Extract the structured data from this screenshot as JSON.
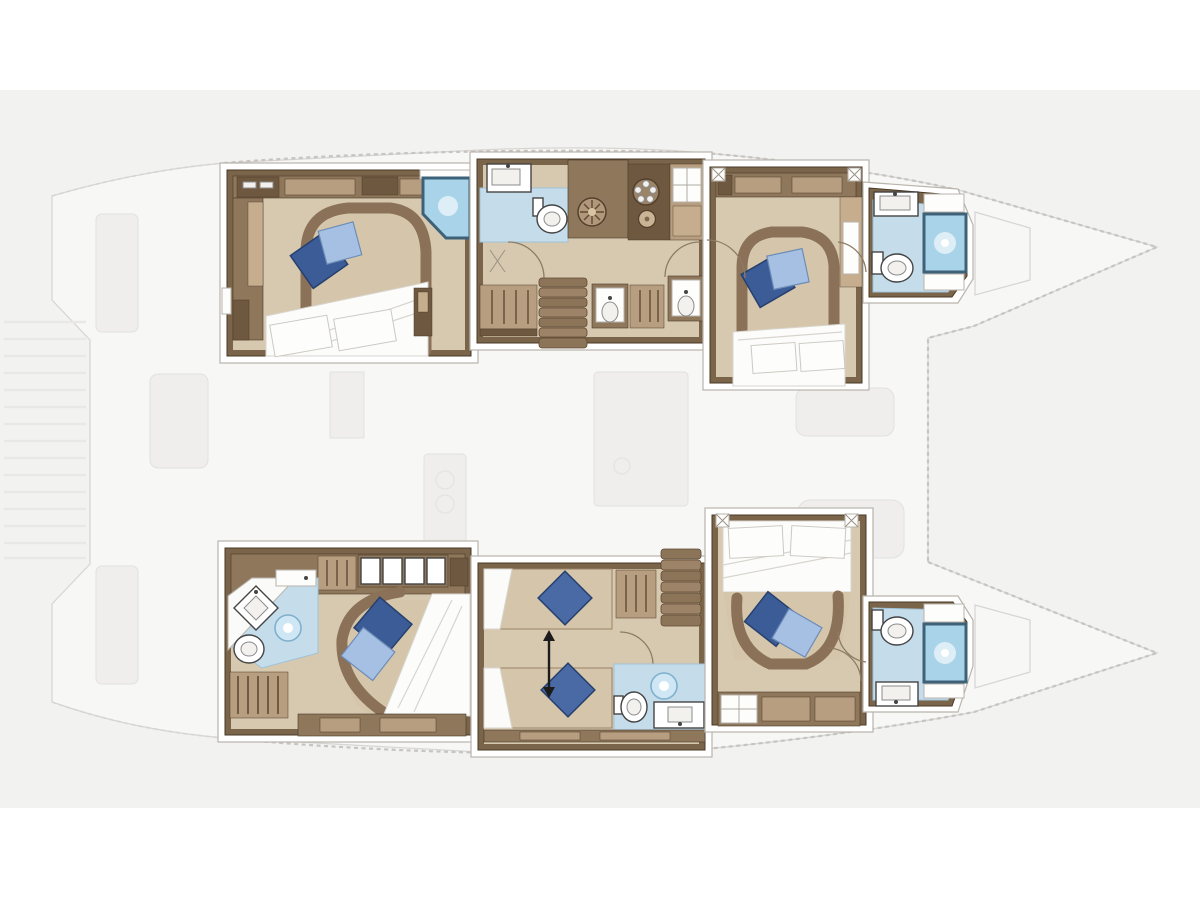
{
  "title": "Catamaran lower deck floor plan",
  "colors": {
    "page-bg": "#ffffff",
    "band-bg": "#f2f2f1",
    "deck-fill": "#f7f7f5",
    "deck-line": "#d6d5d2",
    "dash-line": "#c6c5c2",
    "faded-fill": "#efeeec",
    "faded-dark": "#e5e4e2",
    "faded-line": "#e2e1df",
    "step-line": "#e9e8e6",
    "frame-white": "#ffffff",
    "frame-line": "#b9b4ac",
    "wall": "#7a644a",
    "wall-dark": "#4a3a26",
    "cabinet": "#8f775c",
    "cabinet-light": "#b89e80",
    "cabinet-pale": "#c6ad8e",
    "cabinet-dark": "#6e5940",
    "floor": "#d7c9af",
    "mattress": "#d5c6ab",
    "bed-band": "#8a7157",
    "duvet": "#fcfcfa",
    "duvet-line": "#d8d5ce",
    "pillow-dark": "#3b5c97",
    "pillow-dark-edge": "#27406e",
    "pillow-mid": "#4a6aa5",
    "pillow-light": "#a5c0e2",
    "pillow-light-edge": "#6d8cb8",
    "bath-floor": "#c5ddeb",
    "bath-edge": "#9fc2d8",
    "shower-fill": "#a9d3e8",
    "shower-frame": "#3d6177",
    "shower-soft": "#cfe7f4",
    "shower-ring": "#7fb0cc",
    "shower-glow": "#ddeef7",
    "fixture-line": "#444444",
    "stair-a": "#8c7458",
    "stair-b": "#9d8367",
    "stair-edge": "#5f4a33",
    "door-arc": "#8c7c66",
    "arrow": "#1c1c1c"
  },
  "rooms": {
    "top_aft_cabin": {
      "label": "Aft double cabin, port hull",
      "features": [
        "double-bed-icon",
        "pillow-icon",
        "wardrobe-icon",
        "corner-shower-icon",
        "nightstand-icon"
      ]
    },
    "top_aft_wc": {
      "label": "Aft WC compartment, port hull",
      "features": [
        "toilet-icon",
        "washbasin-icon"
      ]
    },
    "top_galley": {
      "label": "Hull corridor with galley units, port hull",
      "features": [
        "washer-icon",
        "stove-icon",
        "round-sink-icon",
        "locker-icon",
        "vanity-icon"
      ]
    },
    "top_stairs": {
      "label": "Companionway stairs, port hull",
      "features": [
        "stairs-icon"
      ]
    },
    "top_fwd_cabin": {
      "label": "Forward double cabin, port hull",
      "features": [
        "double-bed-icon",
        "pillow-icon",
        "wardrobe-icon"
      ]
    },
    "top_fwd_bath": {
      "label": "Forward bathroom, port hull",
      "features": [
        "shower-icon",
        "toilet-icon",
        "washbasin-icon"
      ]
    },
    "bottom_aft_cabin": {
      "label": "Aft double cabin with en-suite, starboard hull",
      "features": [
        "double-bed-icon",
        "pillow-icon",
        "diamond-basin-icon",
        "toilet-icon",
        "shower-head-icon",
        "wardrobe-icon",
        "louver-locker-icon"
      ]
    },
    "bottom_mid_cabin": {
      "label": "Convertible twin-bed cabin, starboard hull",
      "features": [
        "single-bed-icon",
        "single-bed-icon",
        "pillow-icon",
        "convert-arrow-icon",
        "wardrobe-icon"
      ]
    },
    "bottom_mid_bath": {
      "label": "Mid bathroom, starboard hull",
      "features": [
        "toilet-icon",
        "washbasin-icon",
        "shower-head-icon"
      ]
    },
    "bottom_stairs": {
      "label": "Companionway stairs, starboard hull",
      "features": [
        "stairs-icon"
      ]
    },
    "bottom_fwd_cabin": {
      "label": "Forward double cabin, starboard hull",
      "features": [
        "double-bed-icon",
        "pillow-icon",
        "locker-icon"
      ]
    },
    "bottom_fwd_bath": {
      "label": "Forward bathroom, starboard hull",
      "features": [
        "shower-icon",
        "toilet-icon",
        "washbasin-icon"
      ]
    },
    "saloon": {
      "label": "Saloon and galley silhouette, faded main deck",
      "features": [
        "island-icon",
        "counter-icon",
        "sofa-icon"
      ]
    },
    "cockpit": {
      "label": "Aft cockpit silhouette, faded",
      "features": [
        "bench-icon",
        "table-icon"
      ]
    },
    "transom": {
      "label": "Transom swim steps, faded",
      "features": [
        "steps-icon"
      ]
    },
    "trampoline": {
      "label": "Foredeck and trampoline outline",
      "features": [
        "dashed-outline-icon"
      ]
    },
    "bow_top": {
      "label": "Port bow",
      "features": []
    },
    "bow_bottom": {
      "label": "Starboard bow",
      "features": []
    }
  }
}
